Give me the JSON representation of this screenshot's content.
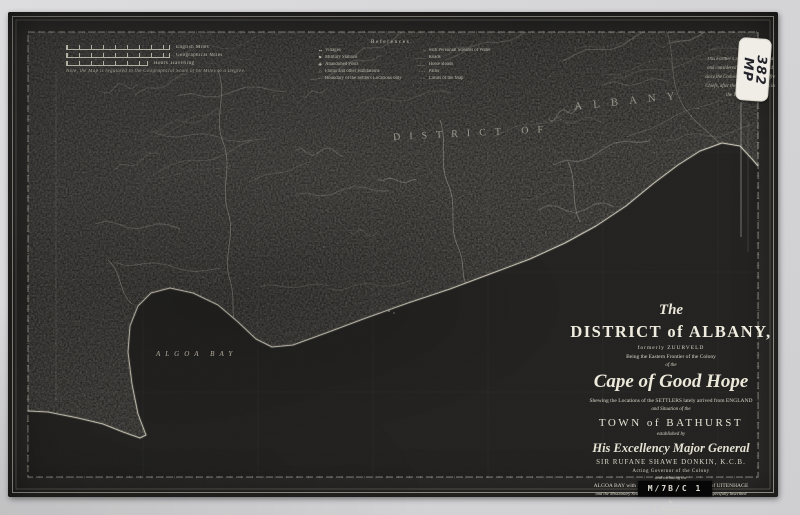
{
  "archive": {
    "sticker_line1": "MP",
    "sticker_line2": "382",
    "reference_code": "M/7B/C 1"
  },
  "scale_bars": {
    "bars": [
      {
        "label": "English Miles"
      },
      {
        "label": "Geographical Miles"
      },
      {
        "label": "Hours Travelling"
      }
    ],
    "note": "Note, the Map is regulated to the Geographical Scale of 60 Miles to a Degree."
  },
  "legend": {
    "title": "References.",
    "left": [
      {
        "symbol": "▪▪",
        "label": "Villages"
      },
      {
        "symbol": "⚑",
        "label": "Military Stations"
      },
      {
        "symbol": "✚",
        "label": "Abandoned Posts"
      },
      {
        "symbol": "○",
        "label": "Farms and other Habitations"
      },
      {
        "symbol": "···",
        "label": "Boundary of the Settlers Locations only"
      }
    ],
    "right": [
      {
        "symbol": "≈",
        "label": "with Perennial Streams of Water"
      },
      {
        "symbol": "—·—",
        "label": "Roads"
      },
      {
        "symbol": "——",
        "label": "Horse Roads"
      },
      {
        "symbol": "- - -",
        "label": "Paths"
      },
      {
        "symbol": "⋯",
        "label": "Limits of the Map"
      }
    ]
  },
  "frontier_note": {
    "lines": [
      "This Farther Country, uninhabited",
      "and considered as neutral Ground",
      "since the Convention with the Caffre",
      "Chiefs, after the last disturbances in",
      "the Year 1819."
    ]
  },
  "map_labels": {
    "district_of": "DISTRICT OF",
    "albany": "ALBANY",
    "algoa_bay": "ALGOA BAY"
  },
  "cartouche": {
    "lines": [
      "The",
      "DISTRICT of ALBANY,",
      "formerly ZUURVELD",
      "Being the Eastern Frontier of the Colony",
      "of the",
      "Cape of Good Hope",
      "Shewing the Locations of the SETTLERS lately arrived from ENGLAND",
      "and Situation of the",
      "TOWN of BATHURST",
      "established by",
      "His Excellency Major General",
      "SIR RUFANE SHAWE DONKIN, K.C.B.",
      "Acting Governor of the Colony",
      "and including the",
      "ALGOA BAY with PORT ELIZABETH, the Village of UITENHAGE",
      "and the Missionary Settlements &c. accurately Surveyed and Respectfully Inscribed",
      "by",
      "J. Knobel.",
      "1820.",
      "London: Published by W. Faden, Geographer to His Majesty."
    ]
  },
  "colors": {
    "page_bg": "#d6d6d8",
    "sheet_bg": "#2b2a28",
    "ink": "#cfcaba",
    "bright_ink": "#e9e5d8",
    "sticker_bg": "#efede6",
    "ref_box_bg": "#070707",
    "ref_box_text": "#e0ddd4"
  }
}
